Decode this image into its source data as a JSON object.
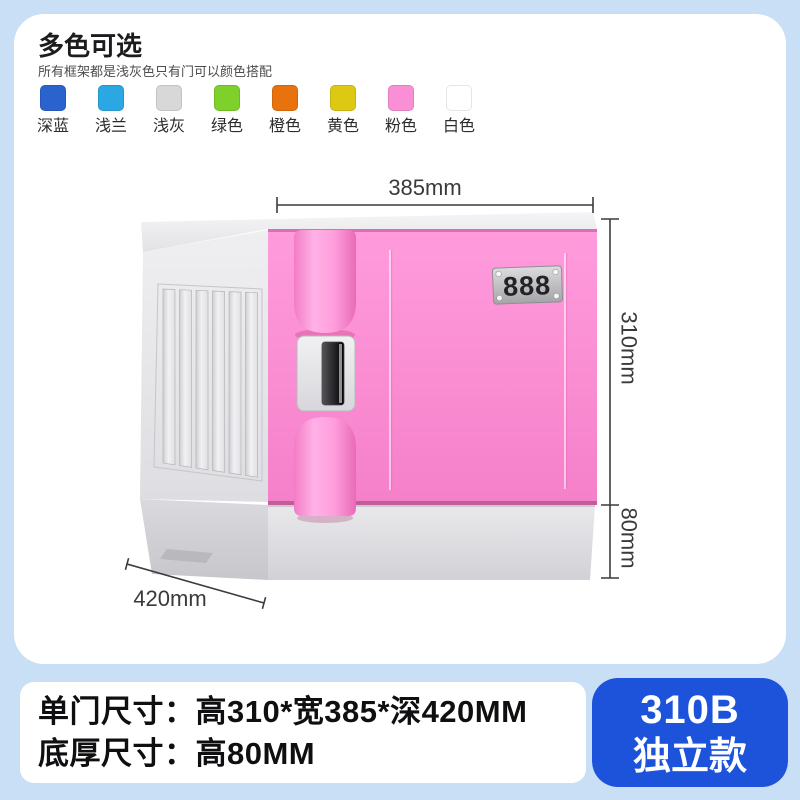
{
  "page": {
    "background": "#c9dff6"
  },
  "color_section": {
    "title": "多色可选",
    "subtitle": "所有框架都是浅灰色只有门可以颜色搭配",
    "swatches": [
      {
        "label": "深蓝",
        "color": "#2a63cd"
      },
      {
        "label": "浅兰",
        "color": "#2ba7e4"
      },
      {
        "label": "浅灰",
        "color": "#d8d8d8"
      },
      {
        "label": "绿色",
        "color": "#7ed02a"
      },
      {
        "label": "橙色",
        "color": "#e7720e"
      },
      {
        "label": "黄色",
        "color": "#ddc814"
      },
      {
        "label": "粉色",
        "color": "#fb8fd6"
      },
      {
        "label": "白色",
        "color": "#ffffff"
      }
    ]
  },
  "locker": {
    "door_number": "888",
    "door_color": "#fb8fd4",
    "frame_color": "#e6e6ea",
    "dim_width": "385mm",
    "dim_height": "310mm",
    "dim_base_height": "80mm",
    "dim_depth": "420mm"
  },
  "specs": {
    "line1": "单门尺寸：高310*宽385*深420MM",
    "line2": "底厚尺寸：高80MM"
  },
  "badge": {
    "model": "310B",
    "variant": "独立款",
    "color": "#1d53da"
  }
}
